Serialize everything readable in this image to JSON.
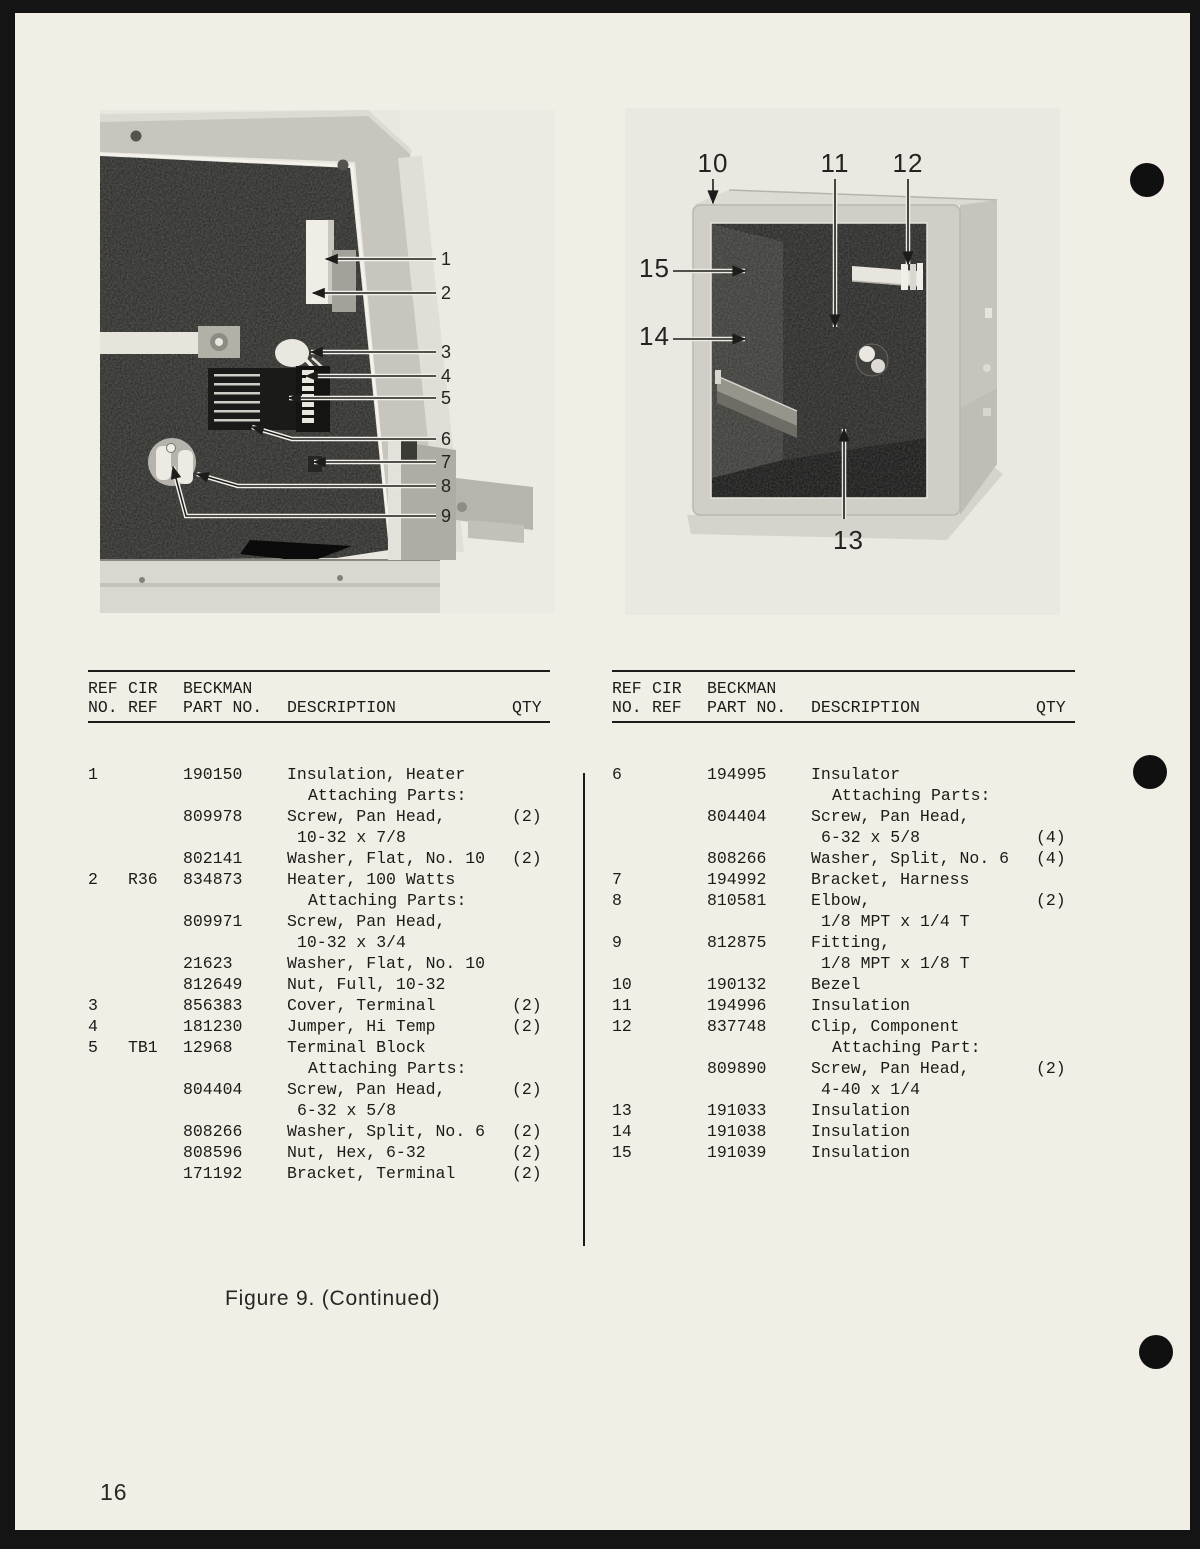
{
  "page": {
    "number": "16",
    "caption": "Figure 9. (Continued)"
  },
  "colors": {
    "paper": "#f1eee5",
    "surround": "#141414",
    "ink": "#1c1c1a",
    "photo_background": "#e9e7e0"
  },
  "figures": {
    "left": {
      "callouts": [
        "1",
        "2",
        "3",
        "4",
        "5",
        "6",
        "7",
        "8",
        "9"
      ]
    },
    "right": {
      "callouts": [
        "10",
        "11",
        "12",
        "13",
        "14",
        "15"
      ]
    }
  },
  "table_header": {
    "row1": [
      "REF",
      "CIR",
      "BECKMAN",
      "",
      ""
    ],
    "row2": [
      "NO.",
      "REF",
      "PART NO.",
      "DESCRIPTION",
      "QTY"
    ]
  },
  "parts_tables": {
    "left": {
      "rows": [
        [
          "1",
          "",
          "190150",
          "Insulation, Heater",
          "",
          0
        ],
        [
          "",
          "",
          "",
          "Attaching Parts:",
          "",
          2
        ],
        [
          "",
          "",
          "809978",
          "Screw, Pan Head,",
          "(2)",
          0
        ],
        [
          "",
          "",
          "",
          "10-32 x 7/8",
          "",
          1
        ],
        [
          "",
          "",
          "802141",
          "Washer, Flat, No. 10",
          "(2)",
          0
        ],
        [
          "2",
          "R36",
          "834873",
          "Heater, 100 Watts",
          "",
          0
        ],
        [
          "",
          "",
          "",
          "Attaching Parts:",
          "",
          2
        ],
        [
          "",
          "",
          "809971",
          "Screw, Pan Head,",
          "",
          0
        ],
        [
          "",
          "",
          "",
          "10-32 x 3/4",
          "",
          1
        ],
        [
          "",
          "",
          "21623",
          "Washer, Flat, No. 10",
          "",
          0
        ],
        [
          "",
          "",
          "812649",
          "Nut, Full, 10-32",
          "",
          0
        ],
        [
          "3",
          "",
          "856383",
          "Cover, Terminal",
          "(2)",
          0
        ],
        [
          "4",
          "",
          "181230",
          "Jumper, Hi Temp",
          "(2)",
          0
        ],
        [
          "5",
          "TB1",
          "12968",
          "Terminal Block",
          "",
          0
        ],
        [
          "",
          "",
          "",
          "Attaching Parts:",
          "",
          2
        ],
        [
          "",
          "",
          "804404",
          "Screw, Pan Head,",
          "(2)",
          0
        ],
        [
          "",
          "",
          "",
          "6-32 x 5/8",
          "",
          1
        ],
        [
          "",
          "",
          "808266",
          "Washer, Split, No. 6",
          "(2)",
          0
        ],
        [
          "",
          "",
          "808596",
          "Nut, Hex, 6-32",
          "(2)",
          0
        ],
        [
          "",
          "",
          "171192",
          "Bracket, Terminal",
          "(2)",
          0
        ]
      ]
    },
    "right": {
      "rows": [
        [
          "6",
          "",
          "194995",
          "Insulator",
          "",
          0
        ],
        [
          "",
          "",
          "",
          "Attaching Parts:",
          "",
          2
        ],
        [
          "",
          "",
          "804404",
          "Screw, Pan Head,",
          "",
          0
        ],
        [
          "",
          "",
          "",
          "6-32 x 5/8",
          "(4)",
          1
        ],
        [
          "",
          "",
          "808266",
          "Washer, Split, No. 6",
          "(4)",
          0
        ],
        [
          "7",
          "",
          "194992",
          "Bracket, Harness",
          "",
          0
        ],
        [
          "8",
          "",
          "810581",
          "Elbow,",
          "(2)",
          0
        ],
        [
          "",
          "",
          "",
          "1/8 MPT x 1/4 T",
          "",
          1
        ],
        [
          "9",
          "",
          "812875",
          "Fitting,",
          "",
          0
        ],
        [
          "",
          "",
          "",
          "1/8 MPT x 1/8 T",
          "",
          1
        ],
        [
          "10",
          "",
          "190132",
          "Bezel",
          "",
          0
        ],
        [
          "11",
          "",
          "194996",
          "Insulation",
          "",
          0
        ],
        [
          "12",
          "",
          "837748",
          "Clip, Component",
          "",
          0
        ],
        [
          "",
          "",
          "",
          "Attaching Part:",
          "",
          2
        ],
        [
          "",
          "",
          "809890",
          "Screw, Pan Head,",
          "(2)",
          0
        ],
        [
          "",
          "",
          "",
          "4-40 x 1/4",
          "",
          1
        ],
        [
          "13",
          "",
          "191033",
          "Insulation",
          "",
          0
        ],
        [
          "14",
          "",
          "191038",
          "Insulation",
          "",
          0
        ],
        [
          "15",
          "",
          "191039",
          "Insulation",
          "",
          0
        ]
      ]
    }
  }
}
